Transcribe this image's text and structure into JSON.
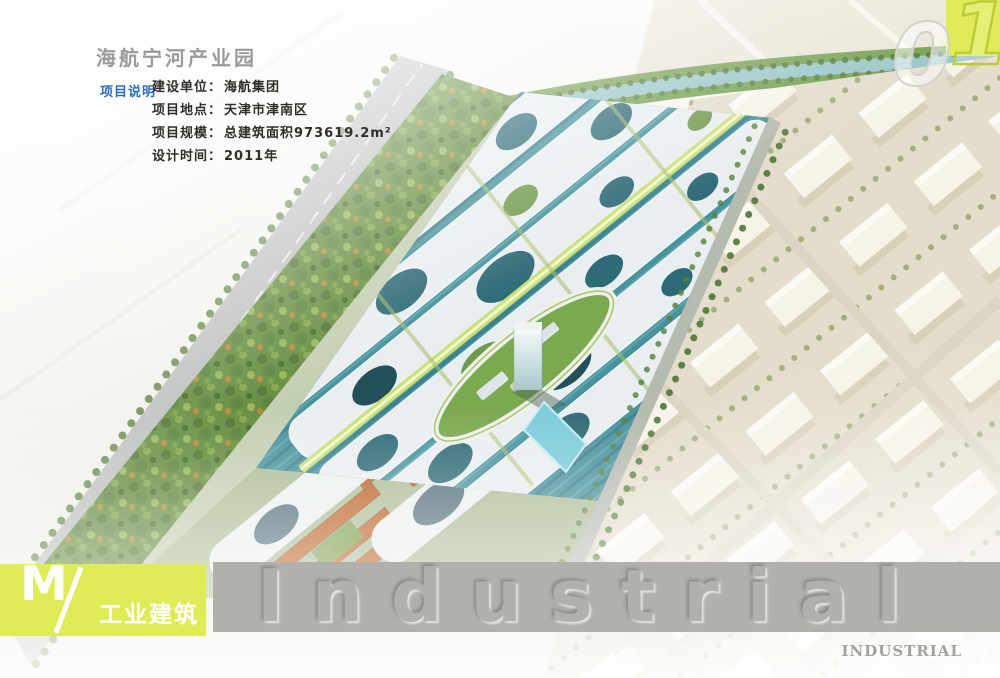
{
  "header": {
    "title": "海航宁河产业园",
    "section_label": "项目说明",
    "info_rows": [
      {
        "label": "建设单位：",
        "value": "海航集团"
      },
      {
        "label": "项目地点：",
        "value": "天津市津南区"
      },
      {
        "label": "项目规模：",
        "value": "总建筑面积973619.2m²"
      },
      {
        "label": "设计时间：",
        "value": "2011年"
      }
    ],
    "page_number": "01",
    "page_number_digits": [
      "0",
      "1"
    ]
  },
  "footer": {
    "category_letter": "M",
    "category_slash": "/",
    "category_label": "工业建筑",
    "watermark": "Industrial",
    "corner_label": "INDUSTRIAL"
  },
  "illustration": {
    "description": "Aerial bird's-eye rendering of an industrial park: white canopy roofs with oval openings over teal glass workshops, orange-roofed blocks, elliptical landscaped plaza with office tower and pool, tree-lined roads, river at top, warehouse grid on beige ground at right"
  },
  "colors": {
    "accent_yellow": "#dfec58",
    "accent_blue": "#2e6fc0",
    "strip_gray": "#b2b0ad",
    "title_gray": "#9b9b9b",
    "canopy_white": "#e9eef0",
    "glass_teal": "#49939e",
    "roof_orange": "#bf6326",
    "field_beige": "#e4ddcb"
  }
}
